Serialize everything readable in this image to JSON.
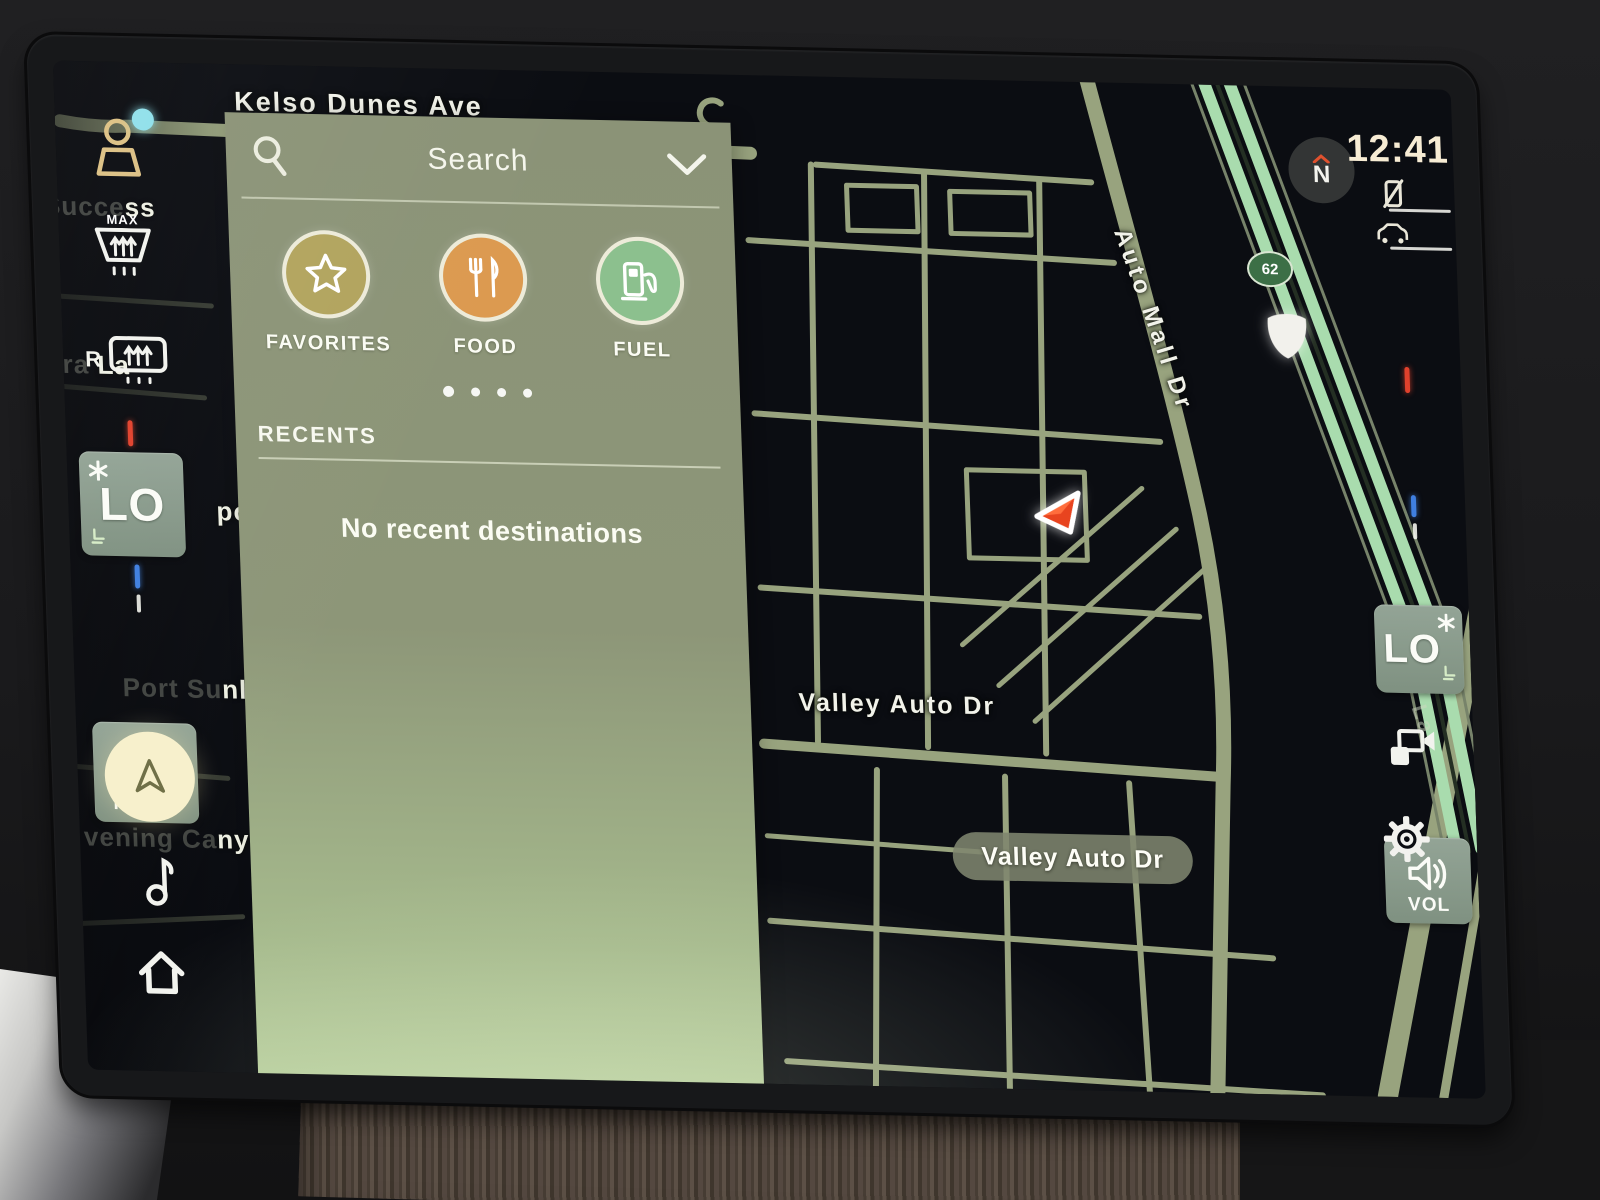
{
  "status_bar": {
    "clock": "12:41",
    "compass": "N"
  },
  "search_panel": {
    "title": "Search",
    "categories": [
      {
        "label": "FAVORITES",
        "icon": "star-icon",
        "color": "#b2a45e"
      },
      {
        "label": "FOOD",
        "icon": "restaurant-icon",
        "color": "#dc9a50"
      },
      {
        "label": "FUEL",
        "icon": "fuel-pump-icon",
        "color": "#8cc08e"
      }
    ],
    "page_dots": 4,
    "recents_header": "RECENTS",
    "recents_empty": "No recent destinations"
  },
  "climate": {
    "max_defrost": "MAX",
    "rear_defrost": "R",
    "left_temp": "LO",
    "right_temp": "LO",
    "mode": "MODE",
    "volume": "VOL"
  },
  "map": {
    "labels": {
      "kelso": "Kelso Dunes Ave",
      "auto_mall": "Auto Mall Dr",
      "valley": "Valley Auto Dr"
    },
    "current_street": "Valley Auto Dr",
    "route_badge": "62",
    "edge_label": "La",
    "dim_labels": [
      {
        "dim": "int Succe",
        "bright": "ss"
      },
      {
        "dim": "rra ",
        "bright": "La"
      },
      {
        "dim": "",
        "bright": "po"
      },
      {
        "dim": "Port Su",
        "bright": "nl"
      },
      {
        "dim": "vening Ca",
        "bright": "ny"
      }
    ]
  },
  "colors": {
    "panel": "#8c9377",
    "map_bg": "#0b0d12",
    "road": "#98a37e",
    "highway": "#a9dcae",
    "hot": "#e0412c",
    "cold": "#3f7fe0",
    "favorites": "#b2a45e",
    "food": "#dc9a50",
    "fuel": "#8cc08e"
  }
}
